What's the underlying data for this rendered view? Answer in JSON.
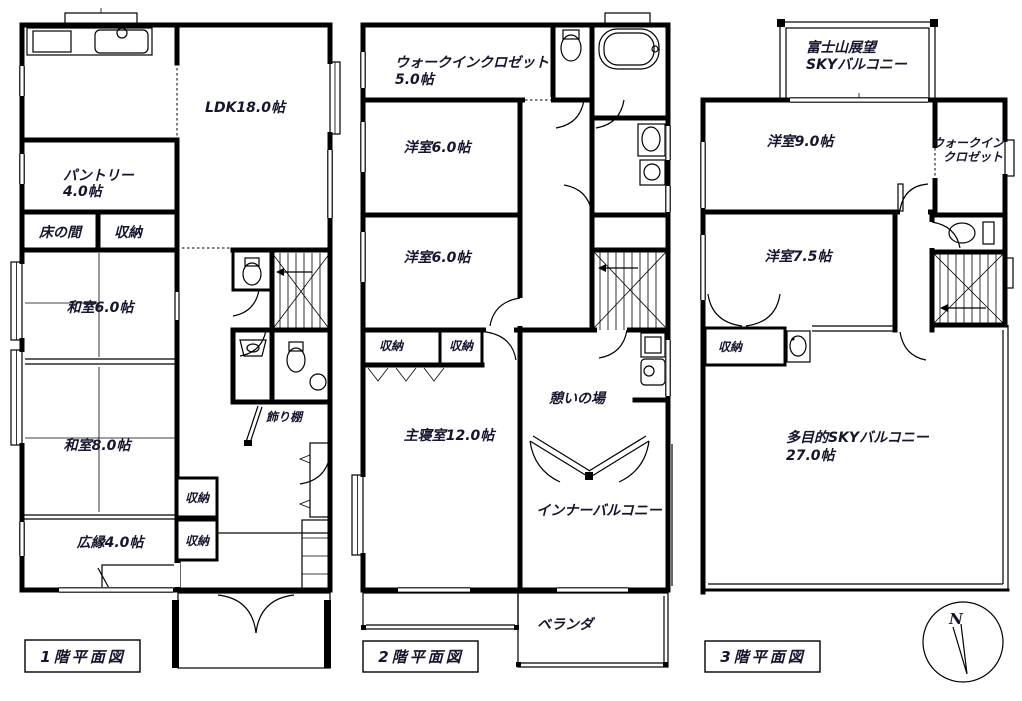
{
  "colors": {
    "background": "#ffffff",
    "line": "#000000",
    "text": "#15152e"
  },
  "floor1": {
    "title": "1階平面図",
    "ldk": "LDK18.0帖",
    "pantry_line1": "パントリー",
    "pantry_line2": "4.0帖",
    "tokonoma": "床の間",
    "closet_a": "収納",
    "washitsu6": "和室6.0帖",
    "washitsu8": "和室8.0帖",
    "closet_b": "収納",
    "closet_c": "収納",
    "hiroen": "広縁4.0帖",
    "kazaridana": "飾り棚"
  },
  "floor2": {
    "title": "2階平面図",
    "wic_line1": "ウォークインクロゼット",
    "wic_line2": "5.0帖",
    "youshitsu6_a": "洋室6.0帖",
    "youshitsu6_b": "洋室6.0帖",
    "closet_a": "収納",
    "closet_b": "収納",
    "master_bedroom": "主寝室12.0帖",
    "ikoi": "憩いの場",
    "inner_balcony": "インナーバルコニー",
    "veranda": "ベランダ"
  },
  "floor3": {
    "title": "3階平面図",
    "sky_line1": "富士山展望",
    "sky_line2": "SKYバルコニー",
    "youshitsu9": "洋室9.0帖",
    "wic_line1": "ウォークイン",
    "wic_line2": "クロゼット",
    "youshitsu75": "洋室7.5帖",
    "closet": "収納",
    "balcony_line1": "多目的SKYバルコニー",
    "balcony_line2": "27.0帖",
    "compass_north": "N"
  }
}
